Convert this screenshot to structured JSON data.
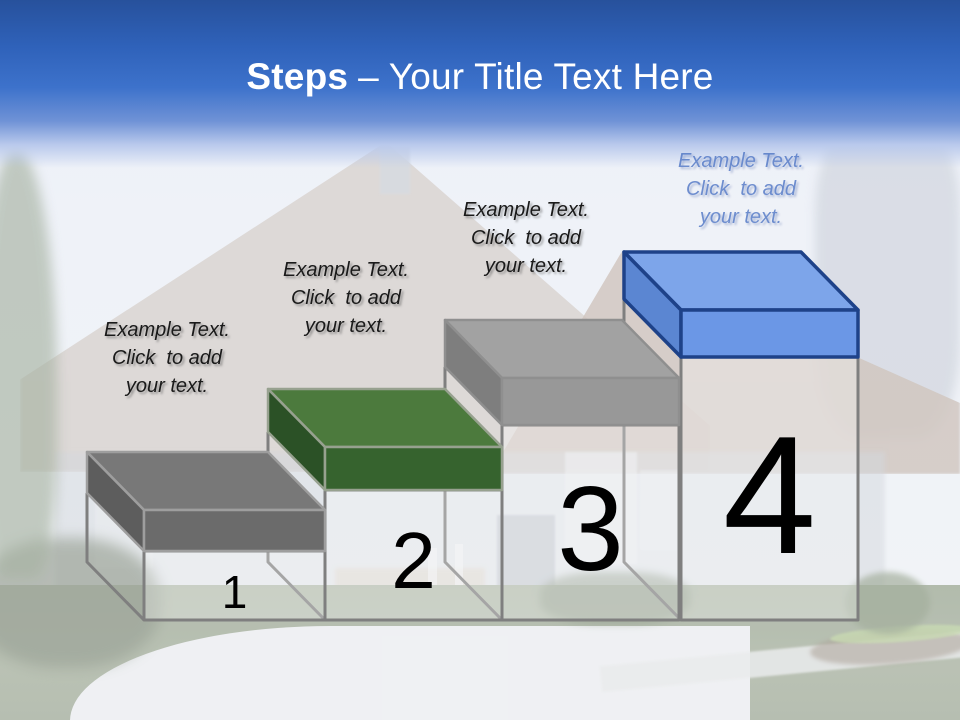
{
  "slide_title": {
    "bold": "Steps",
    "regular": "– Your Title Text Here",
    "color": "#ffffff"
  },
  "steps": [
    {
      "number": "1",
      "label": "Example Text.\nClick  to add\nyour text.",
      "label_color": "#1a1a1a",
      "colors": {
        "top": "#787878",
        "front": "#6b6b6b",
        "side": "#5d5d5d",
        "outline": "#9e9e9e"
      }
    },
    {
      "number": "2",
      "label": "Example Text.\nClick  to add\nyour text.",
      "label_color": "#1a1a1a",
      "colors": {
        "top": "#4c7a3d",
        "front": "#36632e",
        "side": "#2b5126",
        "outline": "#97a18f"
      }
    },
    {
      "number": "3",
      "label": "Example Text.\nClick  to add\nyour text.",
      "label_color": "#1a1a1a",
      "colors": {
        "top": "#a2a2a2",
        "front": "#989898",
        "side": "#7e7e7e",
        "outline": "#8f8f8f"
      }
    },
    {
      "number": "4",
      "label": "Example Text.\nClick  to add\nyour text.",
      "label_color": "#4d74c4",
      "colors": {
        "top": "#7da5ea",
        "front": "#6b97e6",
        "side": "#5b86d2",
        "outline": "#1e4289"
      }
    }
  ],
  "box": {
    "outline_color": "#7f7f7f",
    "fill": "rgba(255,255,255,0.3)",
    "number_color": "#000000"
  }
}
